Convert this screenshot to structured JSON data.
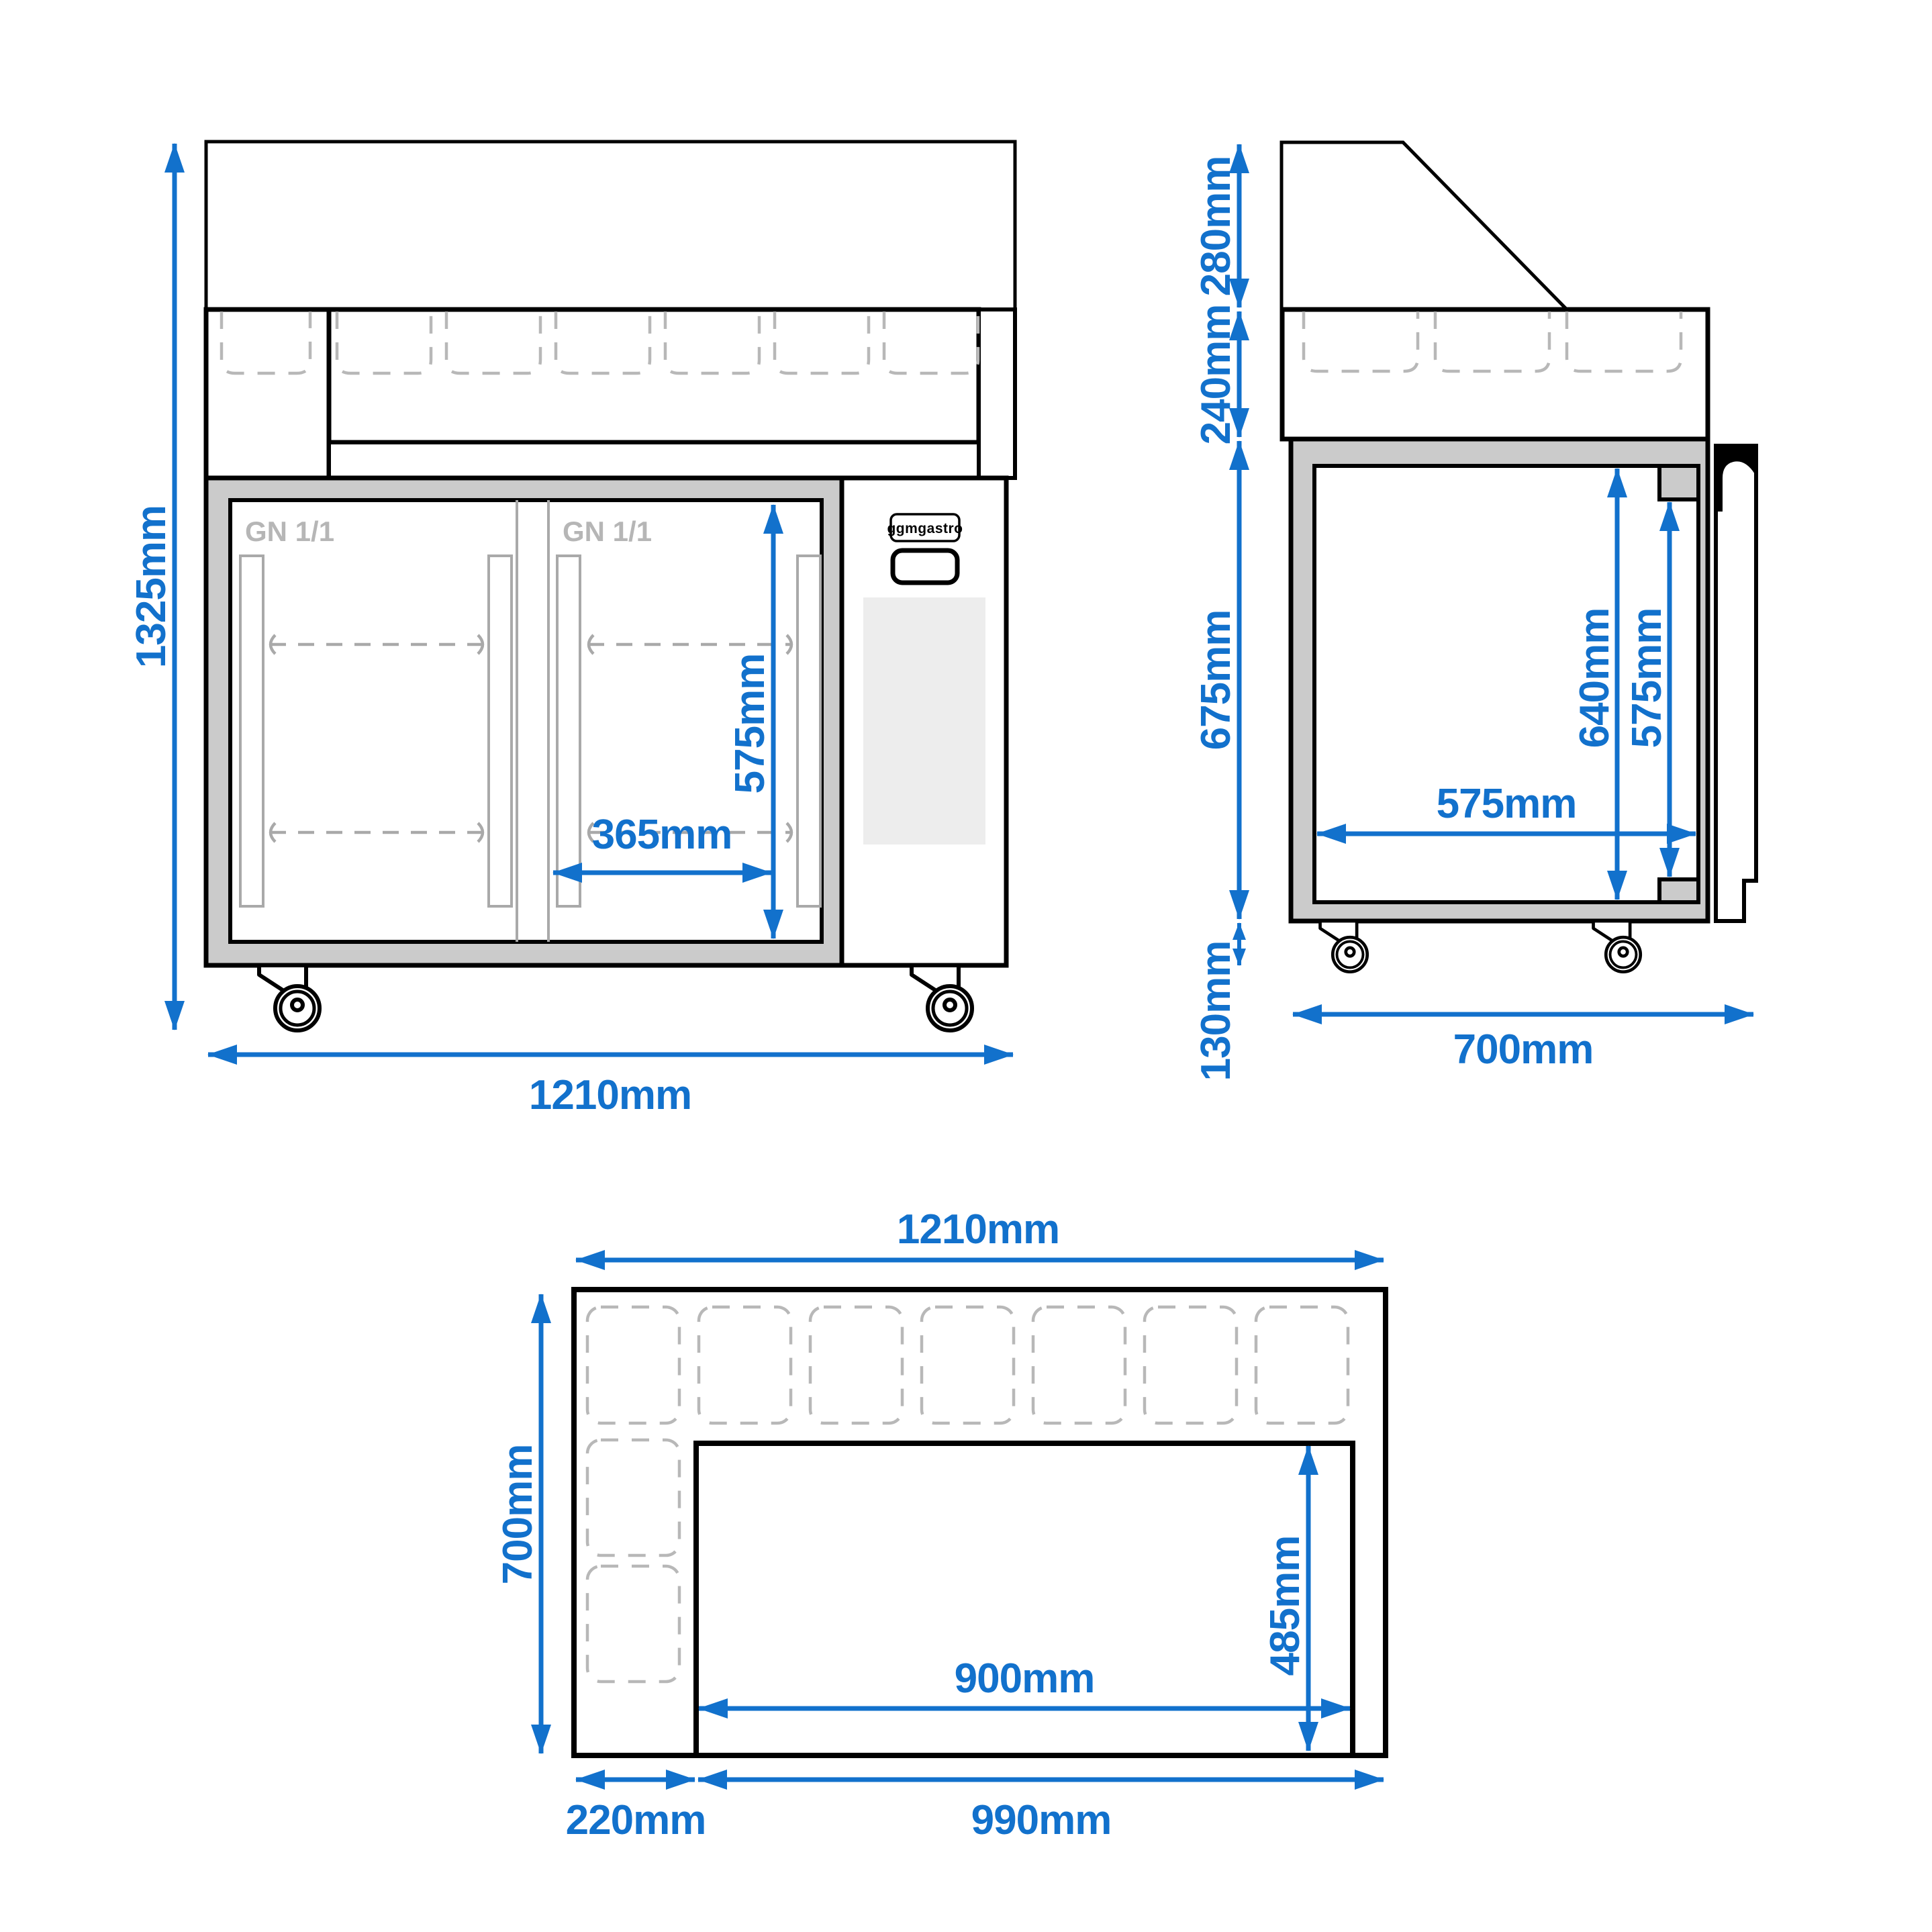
{
  "colors": {
    "accent": "#1271cc",
    "insulation": "#cbcbcb",
    "dashed_gray": "#b8b8b8",
    "detail_gray": "#a9a9a9",
    "label_gray": "#b6b6b6",
    "vent_gray": "#ededed",
    "line": "#000000",
    "background": "#ffffff"
  },
  "brand": {
    "logo_text": "ggmgastro"
  },
  "views": {
    "front": {
      "overall_height": "1325mm",
      "overall_width": "1210mm",
      "interior_height": "575mm",
      "door_interior_width": "365mm",
      "door_labels": [
        "GN 1/1",
        "GN 1/1"
      ]
    },
    "side": {
      "canopy_height": "280mm",
      "gn_well_height": "240mm",
      "body_height": "675mm",
      "caster_height": "130mm",
      "overall_depth": "700mm",
      "interior_height_rear": "640mm",
      "interior_height_front": "575mm",
      "interior_depth": "575mm"
    },
    "top": {
      "overall_width": "1210mm",
      "overall_depth": "700mm",
      "compressor_side_width": "220mm",
      "cutout_side_width": "990mm",
      "cutout_width": "900mm",
      "cutout_depth": "485mm"
    }
  }
}
